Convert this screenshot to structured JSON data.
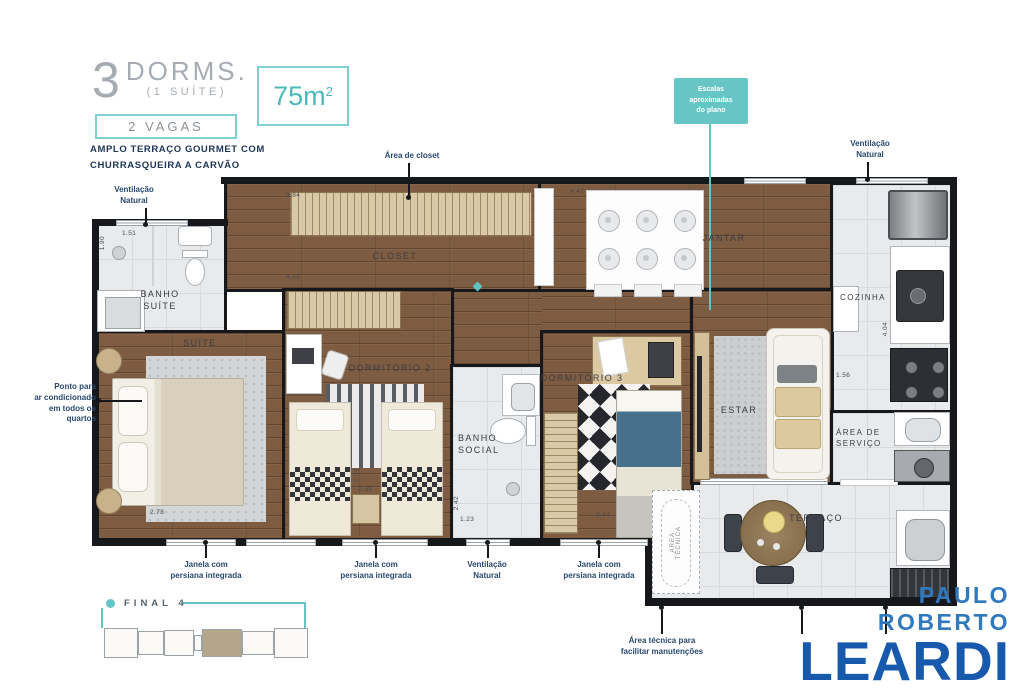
{
  "header": {
    "number": "3",
    "dorms": "DORMS.",
    "suite": "(1 SUÍTE)",
    "vagas": "2 VAGAS",
    "feature": "AMPLO TERRAÇO GOURMET COM\nCHURRASQUEIRA A CARVÃO"
  },
  "area_badge": {
    "value": "75m",
    "sup": "2"
  },
  "callout": {
    "text": "Escalas\naproximadas\ndo plano"
  },
  "rooms": {
    "banho_suite": "BANHO\nSUÍTE",
    "suite": "SUÍTE",
    "closet": "CLOSET",
    "jantar": "JANTAR",
    "cozinha": "COZINHA",
    "dormitorio2": "DORMITÓRIO 2",
    "banho_social": "BANHO\nSOCIAL",
    "dormitorio3": "DORMITÓRIO 3",
    "estar": "ESTAR",
    "servico": "ÁREA DE\nSERVIÇO",
    "terraco": "TERRAÇO",
    "area_tecnica": "ÁREA\nTÉCNICA"
  },
  "annotations": {
    "vent_natural_tl": "Ventilação\nNatural",
    "area_closet": "Área de closet",
    "vent_natural_tr": "Ventilação\nNatural",
    "ac_note": "Ponto para\nar condicionado\nem todos os\nquartos",
    "janela_1": "Janela com\npersiana integrada",
    "janela_2": "Janela com\npersiana integrada",
    "vent_natural_b": "Ventilação\nNatural",
    "janela_3": "Janela com\npersiana integrada",
    "area_tecnica_note": "Área técnica para\nfacilitar manutenções"
  },
  "measurements": {
    "banho_w": "1.51",
    "banho_h": "1.90",
    "closet_top": "3.84",
    "closet_w": "4.62",
    "jantar_w": "4.42",
    "suite_w": "2.78",
    "dorm2_a": "2.34",
    "dorm2_b": "2.39",
    "social_h": "2.42",
    "social_w": "1.23",
    "dorm3_w": "2.44",
    "cozinha_h": "4.04",
    "estar_w": "1.56"
  },
  "keyplan": {
    "label": "FINAL 4"
  },
  "logo": {
    "top": "PAULO ROBERTO",
    "name": "LEARDI"
  },
  "colors": {
    "accent_teal": "#66c4c6",
    "annotation_navy": "#28496f",
    "logo_light": "#3079bd",
    "logo_dark": "#1759ac",
    "wood": "#7d5c42",
    "tile": "#e9eaec",
    "wall": "#17181c"
  }
}
